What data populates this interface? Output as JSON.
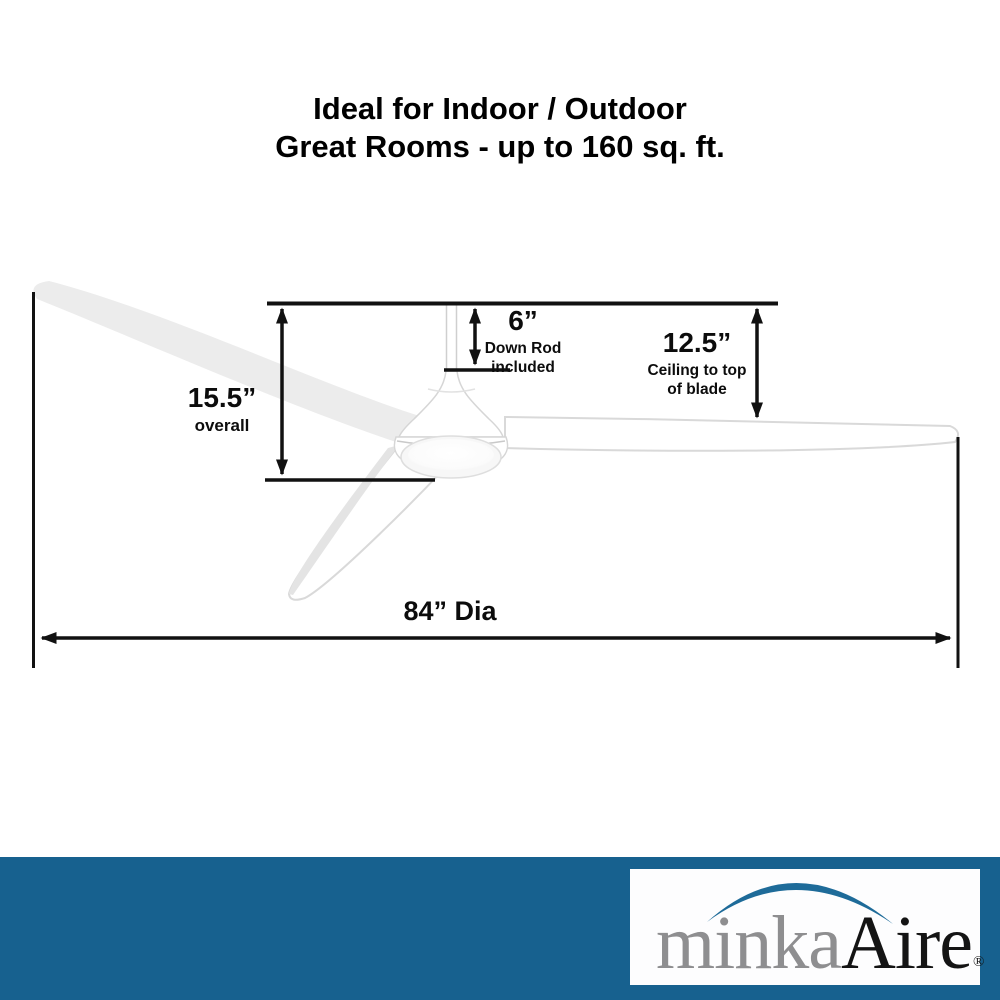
{
  "title": {
    "line1": "Ideal for Indoor / Outdoor",
    "line2": "Great Rooms - up to 160 sq. ft."
  },
  "dimensions": {
    "overall": {
      "value": "15.5”",
      "line1": "overall"
    },
    "down_rod": {
      "value": "6”",
      "line1": "Down Rod",
      "line2": "included"
    },
    "ceiling_to_blade": {
      "value": "12.5”",
      "line1": "Ceiling to top",
      "line2": "of blade"
    },
    "diameter": {
      "value": "84” Dia"
    }
  },
  "logo": {
    "brand_part1": "minka",
    "brand_part2": "Aire",
    "registered_mark": "®"
  },
  "colors": {
    "brand_blue": "#17618F",
    "logo_arc_blue": "#1E6B99",
    "brand_gray": "#8E8E90",
    "line_black": "#111111"
  }
}
